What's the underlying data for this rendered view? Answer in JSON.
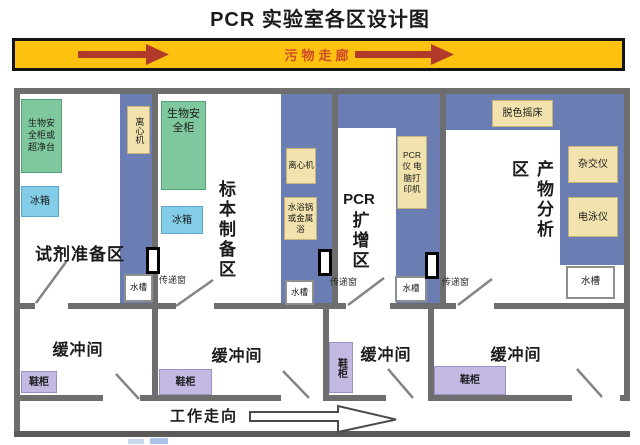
{
  "title": "PCR 实验室各区设计图",
  "waste_corridor": {
    "label": "污物走廊"
  },
  "work_corridor": {
    "label": "工作走向"
  },
  "labels": {
    "pass_window": "传递窗"
  },
  "rooms": {
    "reagent_prep": {
      "name": "试剂准备区",
      "biosafety_cabinet": "生物安全柜或超净台",
      "fridge": "冰箱",
      "centrifuge": "离心机",
      "sink": "水槽"
    },
    "specimen_prep": {
      "name": "标本制备区",
      "biosafety_cabinet": "生物安全柜",
      "fridge": "冰箱",
      "centrifuge": "离心机",
      "water_bath": "水浴锅或金属浴",
      "sink": "水槽"
    },
    "pcr_amplification": {
      "name_prefix": "PCR",
      "name_suffix": "扩增区",
      "pcr_equipment": "PCR仪 电脑打印机",
      "sink": "水槽"
    },
    "product_analysis": {
      "name": "产物分析区",
      "destain_shaker": "脱色摇床",
      "hybridizer": "杂交仪",
      "electrophoresis": "电泳仪",
      "sink": "水槽"
    }
  },
  "buffer_rooms": [
    {
      "name": "缓冲间",
      "shoe_cabinet": "鞋柜"
    },
    {
      "name": "缓冲间",
      "shoe_cabinet": "鞋柜"
    },
    {
      "name": "缓冲间",
      "shoe_cabinet": "鞋柜"
    },
    {
      "name": "缓冲间",
      "shoe_cabinet": "鞋柜"
    }
  ],
  "colors": {
    "banner_bg": "#fdc20f",
    "banner_arrow": "#b23a2a",
    "banner_text": "#cf4a28",
    "wall_gray": "#6e6e6e",
    "bench_blue": "#6b7eb4",
    "biosafety_green": "#7fc79d",
    "fridge_blue": "#84cde8",
    "equipment_tan": "#f2e3ae",
    "cabinet_purple": "#c4b9e3"
  }
}
